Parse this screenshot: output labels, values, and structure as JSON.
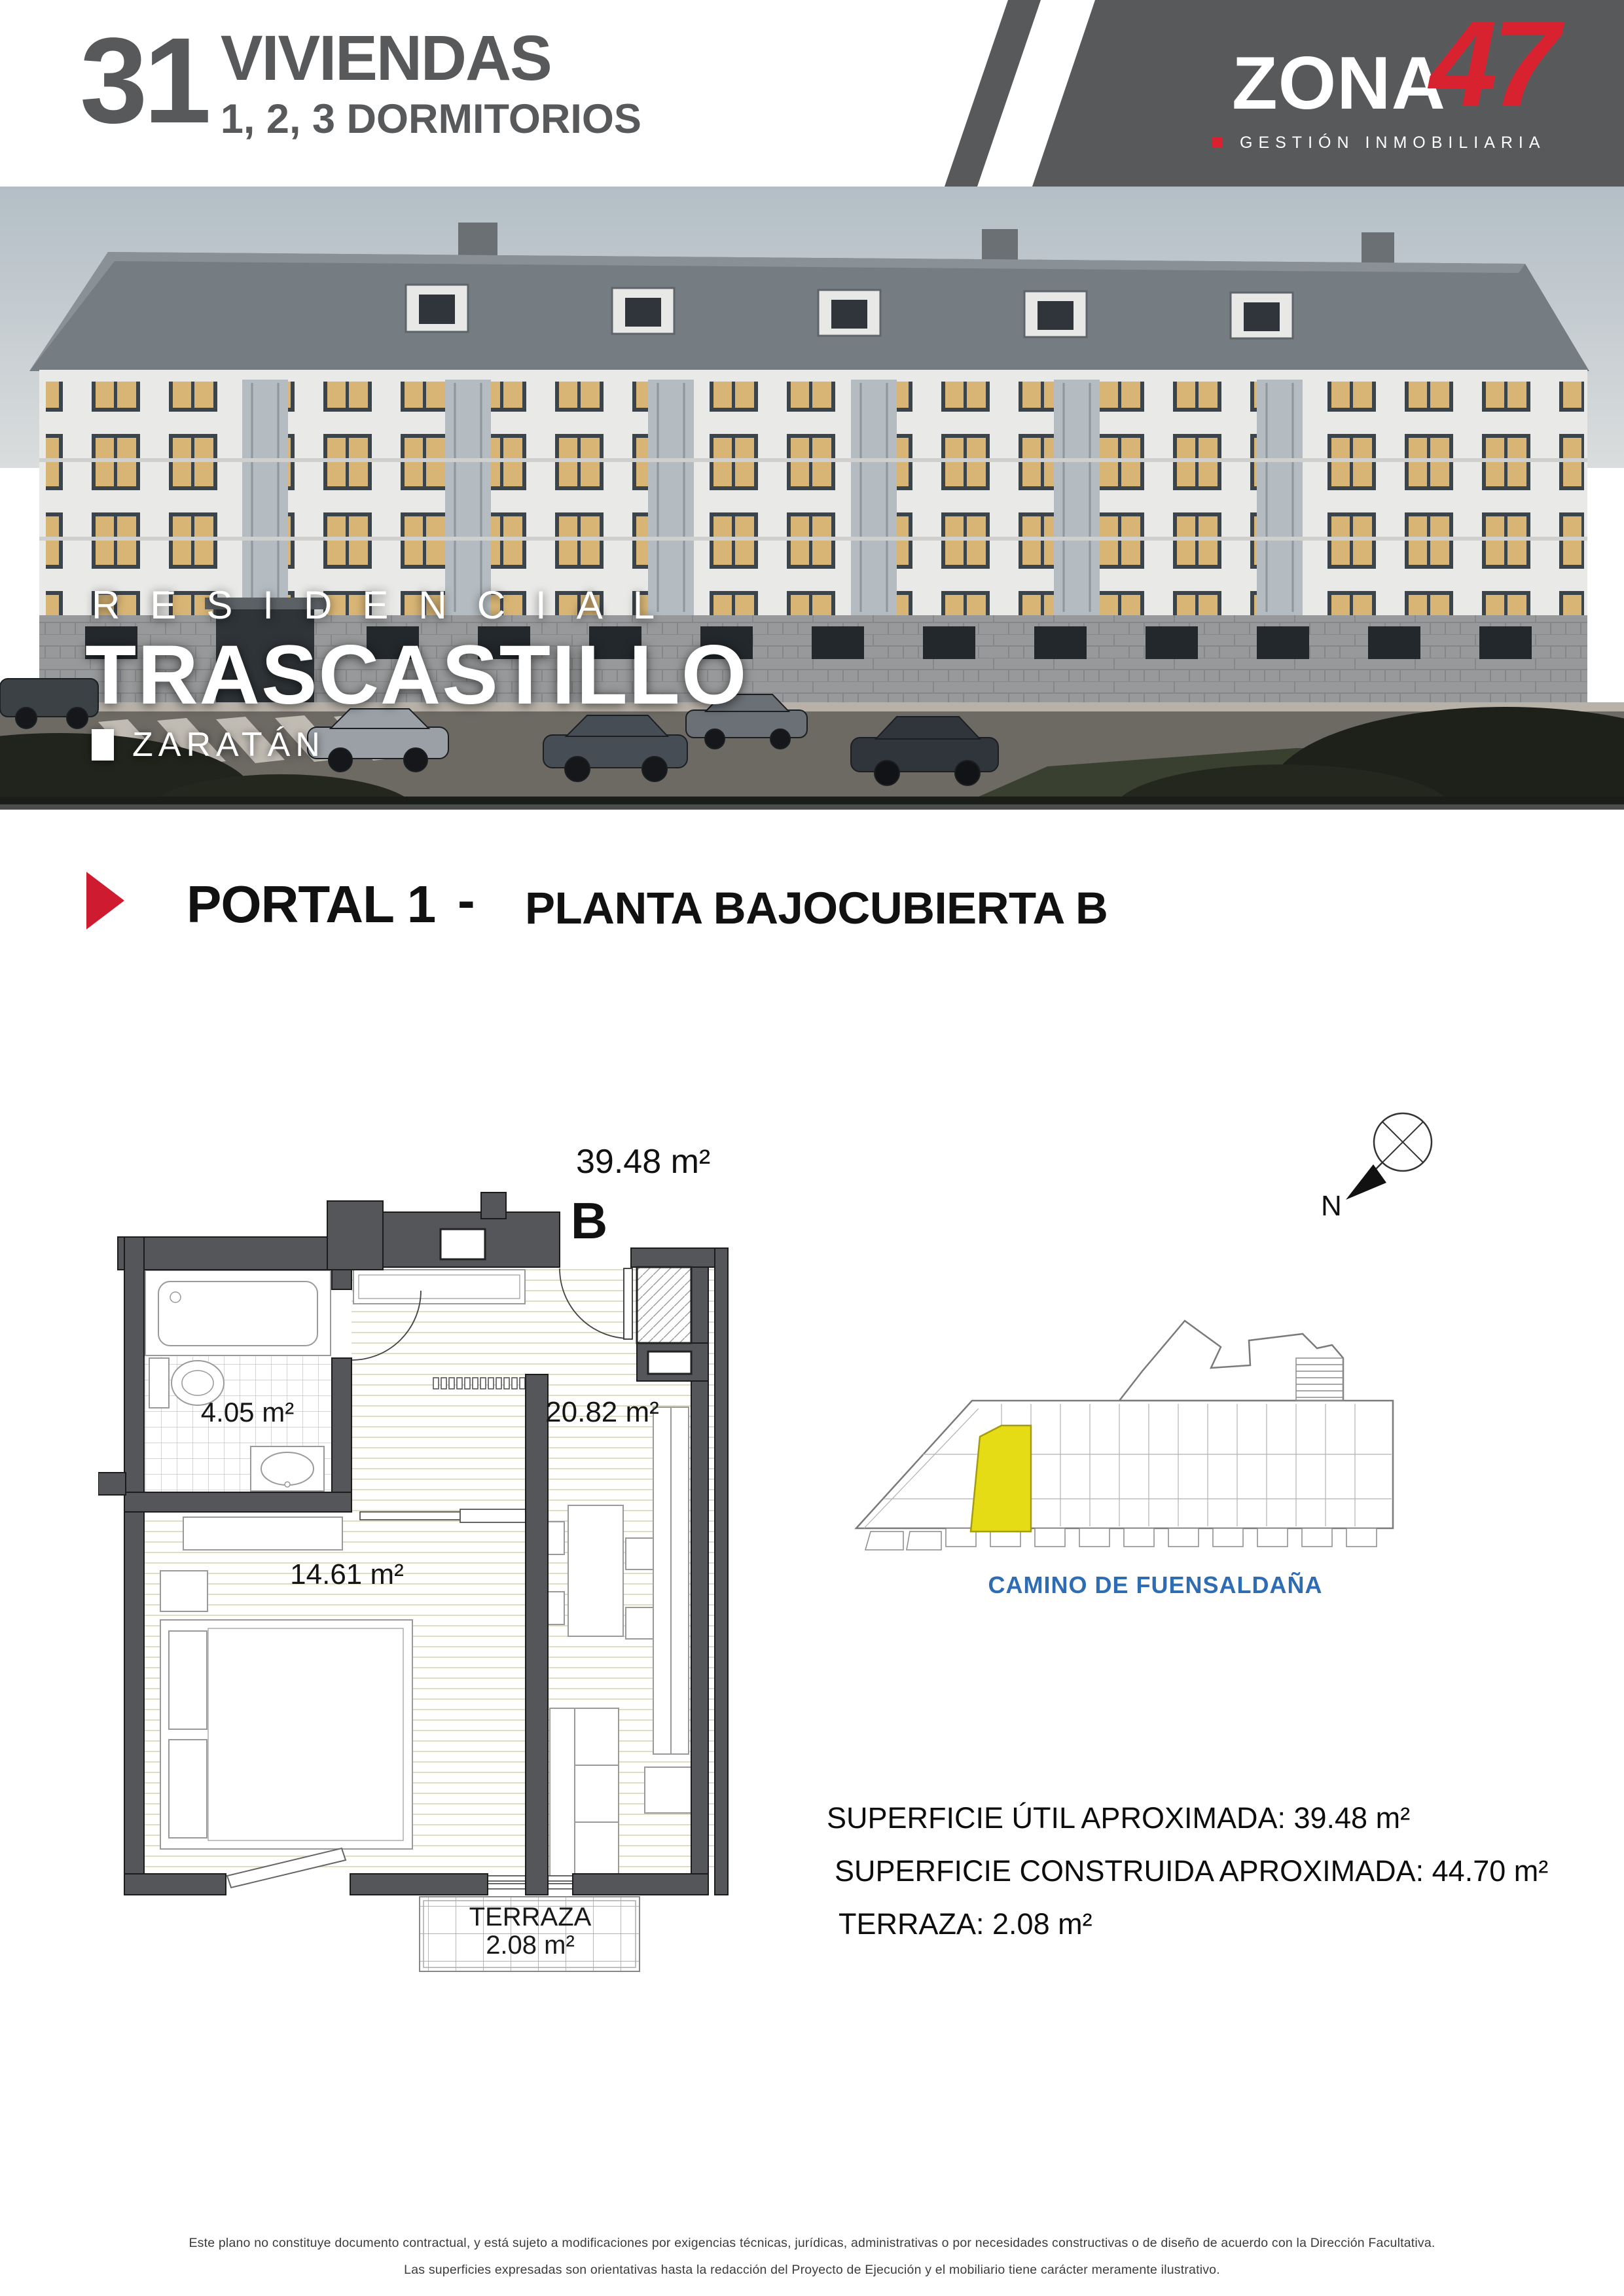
{
  "header": {
    "units_count": "31",
    "units_label": "VIVIENDAS",
    "units_sub": "1, 2, 3 DORMITORIOS",
    "logo": {
      "brand": "ZONA",
      "number": "47",
      "tagline": "GESTIÓN INMOBILIARIA"
    }
  },
  "hero": {
    "pretitle": "RESIDENCIAL",
    "title": "TRASCASTILLO",
    "location": "ZARATÁN"
  },
  "section": {
    "portal": "PORTAL 1",
    "separator": "-",
    "floor": "PLANTA BAJOCUBIERTA B"
  },
  "floorplan": {
    "total_area": "39.48 m²",
    "unit_letter": "B",
    "bathroom_area": "4.05 m²",
    "living_area": "20.82 m²",
    "bedroom_area": "14.61 m²",
    "terrace_label": "TERRAZA",
    "terrace_area": "2.08 m²"
  },
  "siteplan": {
    "street": "CAMINO DE FUENSALDAÑA",
    "compass": "N"
  },
  "summary": {
    "util": "SUPERFICIE ÚTIL APROXIMADA: 39.48 m²",
    "construida": "SUPERFICIE CONSTRUIDA APROXIMADA: 44.70 m²",
    "terraza": "TERRAZA: 2.08 m²"
  },
  "footer": {
    "line1": "Este plano no constituye documento contractual, y está sujeto a modificaciones por exigencias técnicas, jurídicas, administrativas o por necesidades constructivas o de diseño de acuerdo con la Dirección Facultativa.",
    "line2": "Las superficies expresadas son orientativas hasta la redacción del Proyecto de Ejecución y el mobiliario tiene carácter meramente ilustrativo."
  },
  "colors": {
    "accent_red": "#cf1b30",
    "dark_gray": "#58595b",
    "street_blue": "#2e6db4",
    "highlight_yellow": "#e5dc15"
  }
}
